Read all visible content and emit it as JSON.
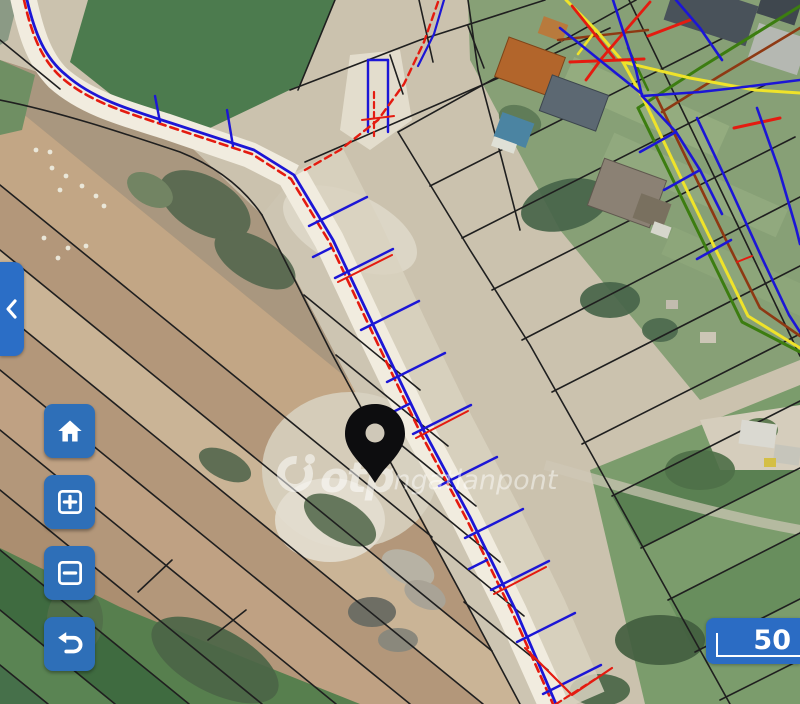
{
  "app": {
    "name": "otp-ingatlanpont-map-viewer"
  },
  "watermark": {
    "logo": "otp-ring-logo",
    "brand_bold": "otp",
    "brand_rest": "ingatlanpont"
  },
  "scale": {
    "value": "50"
  },
  "controls": {
    "collapse": {
      "icon": "chevron-left-icon"
    },
    "buttons": [
      {
        "id": "home",
        "icon": "home-icon"
      },
      {
        "id": "zoom-in",
        "icon": "zoom-in-icon"
      },
      {
        "id": "zoom-out",
        "icon": "zoom-out-icon"
      },
      {
        "id": "undo",
        "icon": "undo-icon"
      }
    ]
  },
  "marker": {
    "type": "location-pin",
    "color": "#0d0d0f"
  },
  "map_layers": {
    "basemap": "aerial-photo",
    "overlays": [
      "cadastral-parcel-lines",
      "utility-lines"
    ],
    "utility_line_colors": [
      "#e41b10",
      "#1c16d6",
      "#efe32a",
      "#3c7d10",
      "#8e3913"
    ]
  },
  "palette": {
    "btn-blue": "#2e6fb8",
    "panel-blue": "#2b6ec6",
    "scale-blue": "#2b6cc4",
    "utility-red": "#e41b10",
    "utility-blue": "#1c16d6",
    "utility-yellow": "#efe32a",
    "utility-green": "#3c7d10",
    "utility-maroon": "#8e3913",
    "parcel-black": "#1f1f1f",
    "road-light": "#f1ecdf",
    "pin-black": "#0d0d0f",
    "watermark-white": "#ffffff"
  }
}
